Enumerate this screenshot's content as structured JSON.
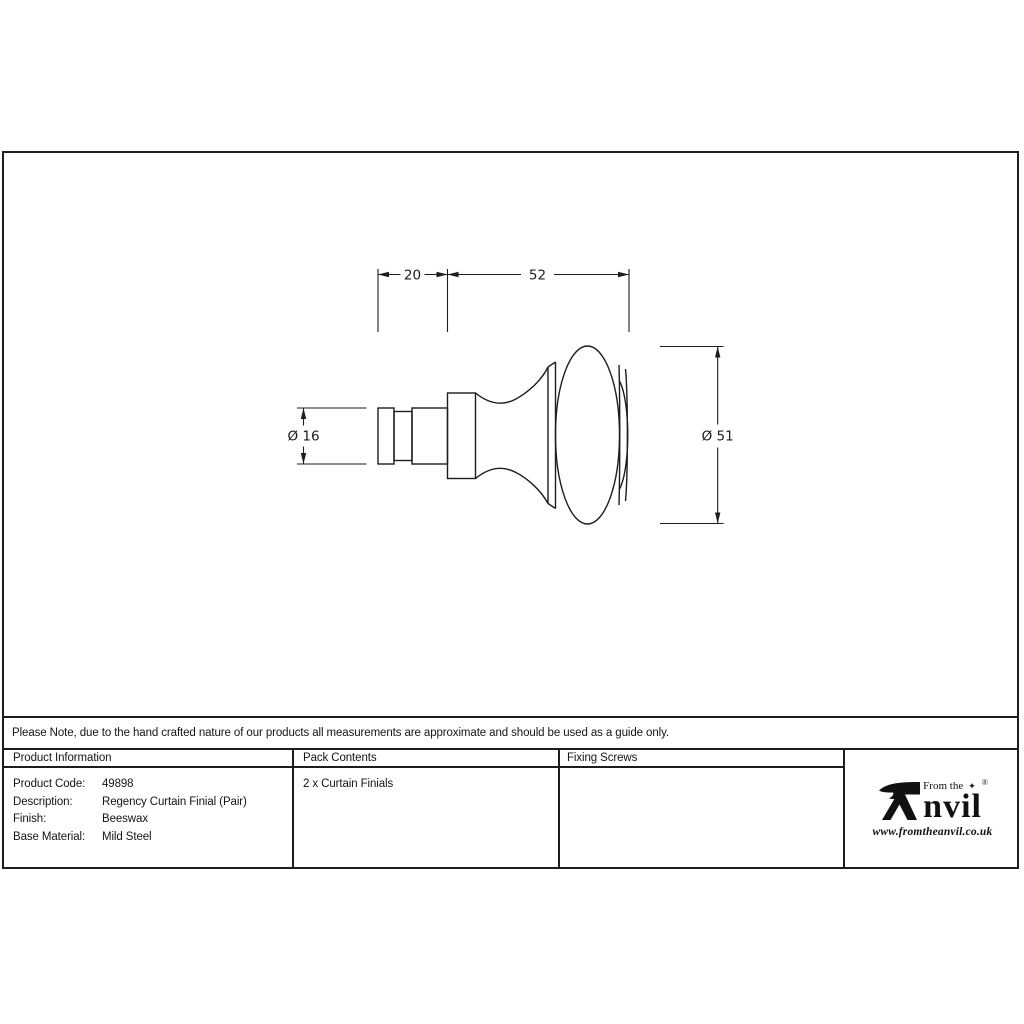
{
  "note": {
    "text": "Please Note, due to the hand crafted nature of our products all measurements are approximate and should be used as a guide only."
  },
  "drawing": {
    "dim_stem_length": "20",
    "dim_knob_length": "52",
    "dim_stem_diameter": "Ø 16",
    "dim_knob_diameter": "Ø 51"
  },
  "table": {
    "headers": {
      "product_information": "Product Information",
      "pack_contents": "Pack Contents",
      "fixing_screws": "Fixing Screws"
    },
    "product_info_rows": [
      {
        "label": "Product Code:",
        "value": "49898"
      },
      {
        "label": "Description:",
        "value": "Regency Curtain Finial (Pair)"
      },
      {
        "label": "Finish:",
        "value": "Beeswax"
      },
      {
        "label": "Base Material:",
        "value": "Mild Steel"
      }
    ],
    "pack_contents_value": "2 x Curtain Finials",
    "fixing_screws_value": ""
  },
  "logo": {
    "tagline": "From the",
    "diamond": "✦",
    "registered": "®",
    "wordmark": "nvil",
    "website": "www.fromtheanvil.co.uk"
  },
  "colors": {
    "line": "#1d1d1d",
    "background": "#ffffff"
  }
}
